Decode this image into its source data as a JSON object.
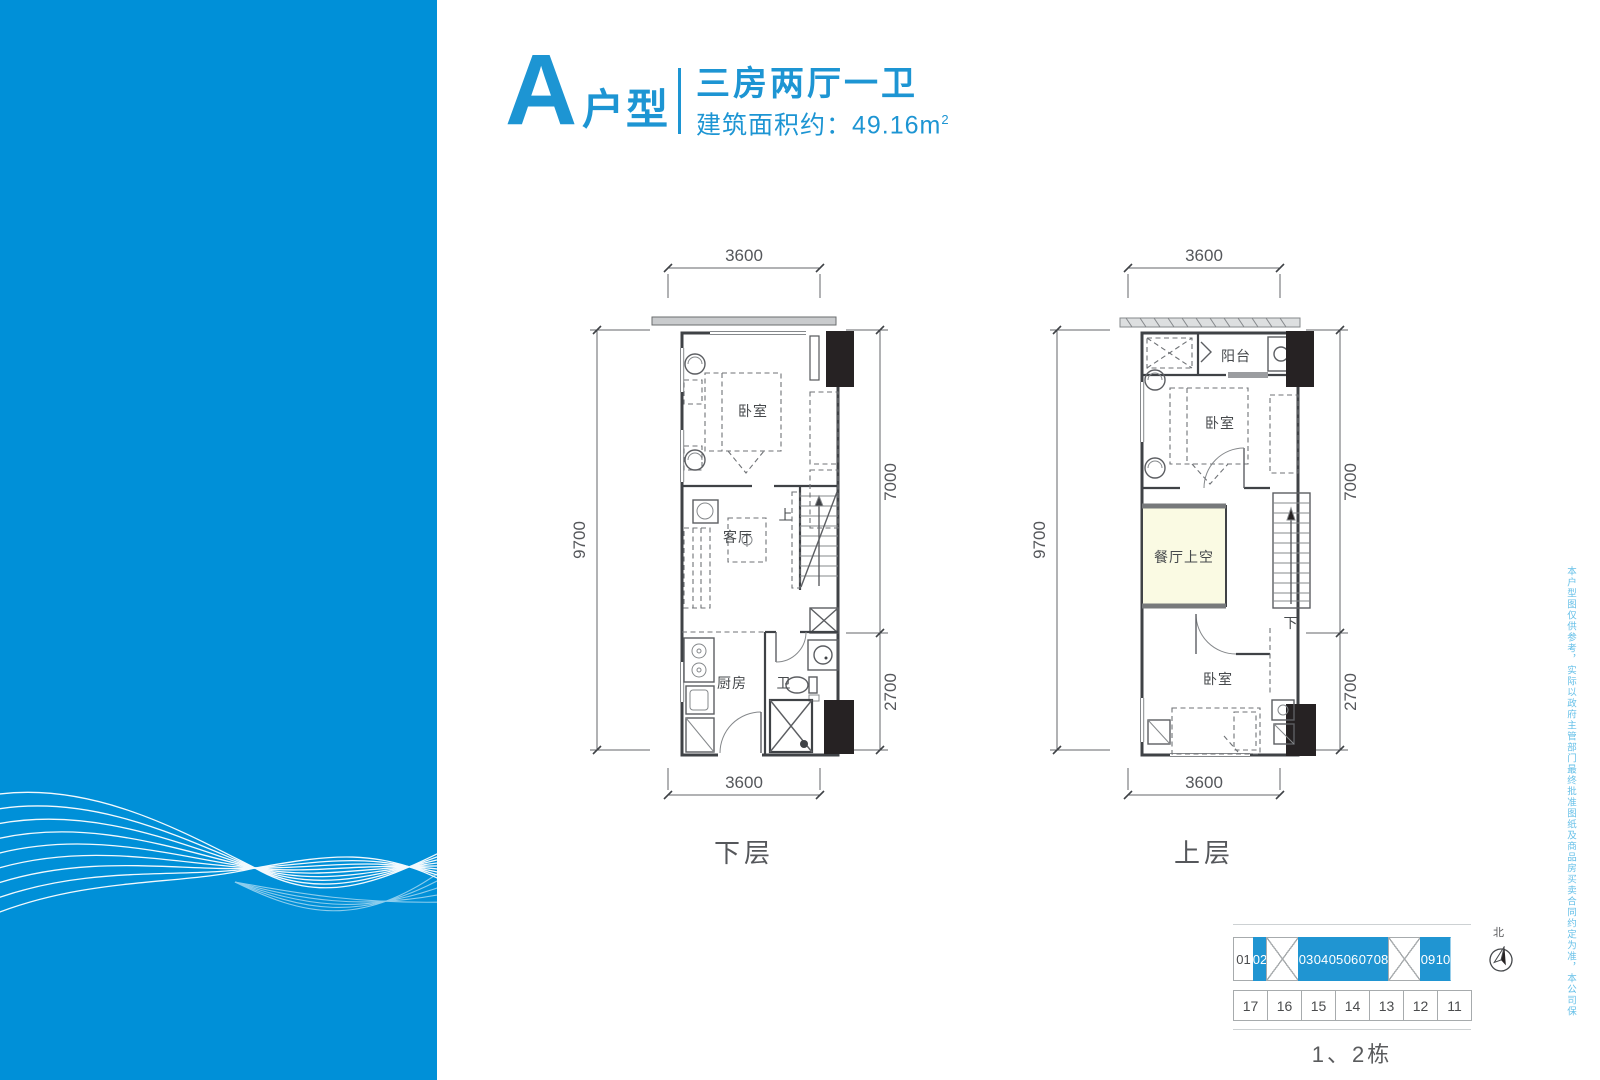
{
  "title": {
    "letter": "A",
    "suffix": "户型",
    "rooms": "三房两厅一卫",
    "area": "建筑面积约：49.16m",
    "area_sup": "2"
  },
  "plans": {
    "lower": {
      "name": "下层",
      "dim_top": "3600",
      "dim_bottom": "3600",
      "dim_left": "9700",
      "dim_right_upper": "7000",
      "dim_right_lower": "2700",
      "rooms": {
        "bedroom": "卧室",
        "living": "客厅",
        "kitchen": "厨房",
        "bath": "卫",
        "stair": "上"
      }
    },
    "upper": {
      "name": "上层",
      "dim_top": "3600",
      "dim_bottom": "3600",
      "dim_left": "9700",
      "dim_right_upper": "7000",
      "dim_right_lower": "2700",
      "rooms": {
        "balcony": "阳台",
        "bedroom_top": "卧室",
        "void": "餐厅上空",
        "bedroom_bottom": "卧室",
        "stair": "下"
      }
    }
  },
  "keyplan": {
    "caption": "1、2栋",
    "north": "北",
    "top_units": [
      "01",
      "02",
      "03",
      "04",
      "05",
      "06",
      "07",
      "08",
      "09",
      "10"
    ],
    "bottom_units": [
      "17",
      "16",
      "15",
      "14",
      "13",
      "12",
      "11"
    ]
  },
  "side_note": "本户型图仅供参考，实际以政府主管部门最终批准图纸及商品房买卖合同约定为准，本公司保留解释权。",
  "colors": {
    "brand_blue": "#1d95d3",
    "panel_blue": "#0090d8",
    "plan_fill_lower": "#dfecf5",
    "plan_fill_upper": "#fafae3",
    "keyplan_highlight": "#2095d2",
    "shaft_black": "#262223"
  }
}
